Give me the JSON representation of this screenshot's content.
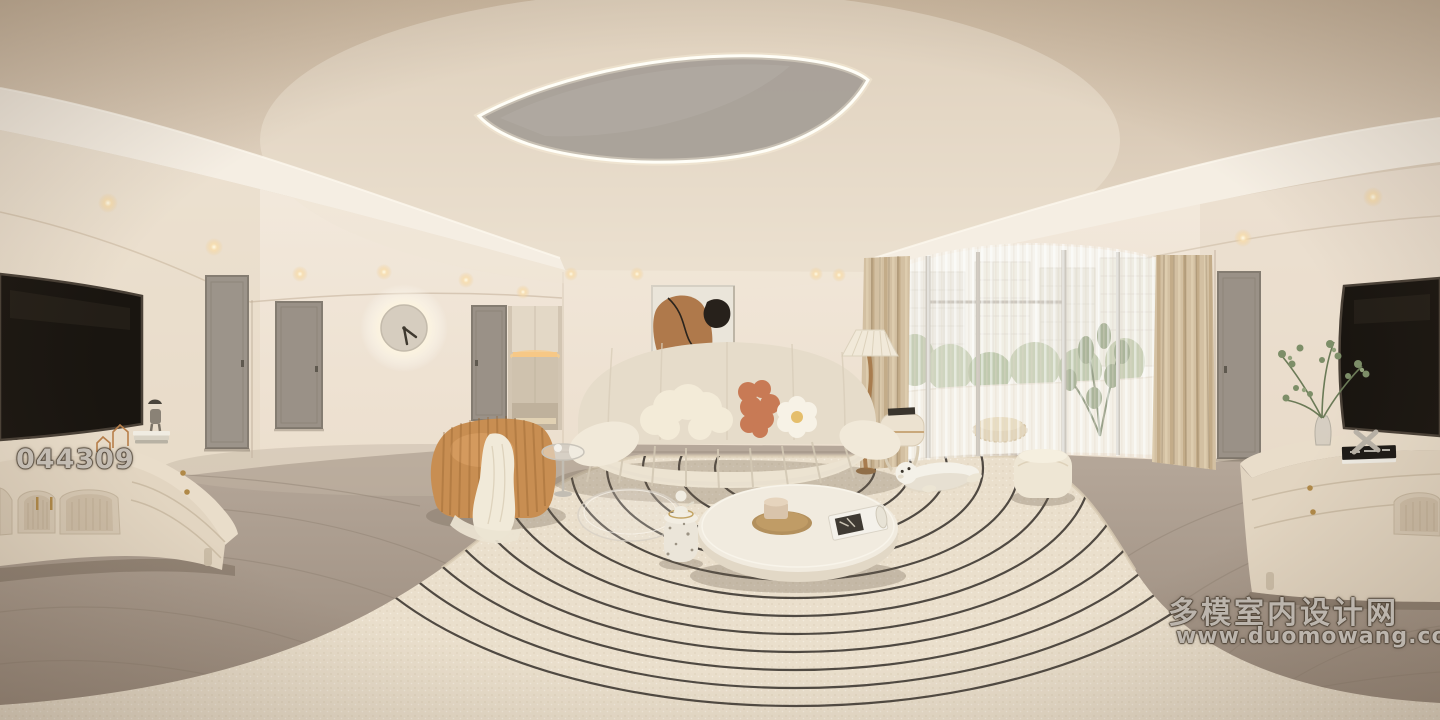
{
  "scene": {
    "kind": "360-degree panorama render",
    "room": "cream minimalist living room"
  },
  "photo_id": "044309",
  "watermark": {
    "line1": "多模室内设计网",
    "line2": "www.duomowang.com"
  },
  "palette": {
    "ceiling": "#d9cab6",
    "wall": "#f0e7da",
    "floor_wood": "#a89a8b",
    "rug": "#eadfcc",
    "rug_lines": "#35302a",
    "sofa": "#e8dfce",
    "pillow_terracotta": "#c87a55",
    "lounge_chair_camel": "#c88e52",
    "curtain_drape": "#d3c0a2",
    "tv_screen": "#191510",
    "console": "#e6dac8",
    "hardware_gold": "#b08948",
    "foliage_green": "#7d8e68"
  }
}
